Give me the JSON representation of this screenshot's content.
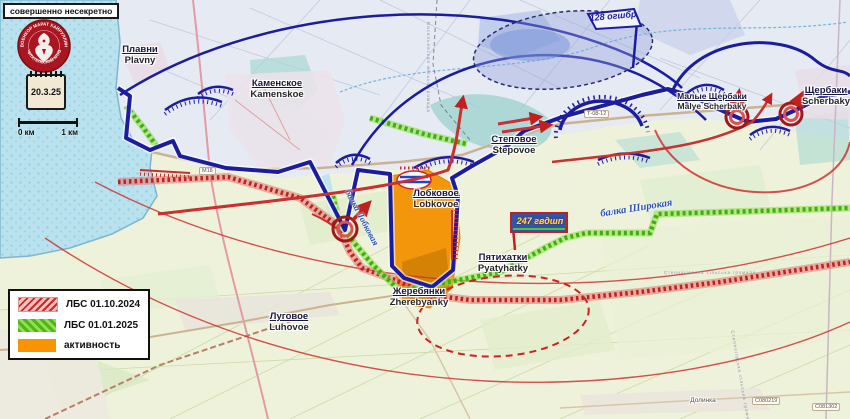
{
  "classification": "совершенно несекретно",
  "emblem": {
    "top": "ВОЕНКОР МАРАТ ХАЙРУЛЛИН",
    "bottom": "ЧИТАТЕЛЬСКИЙ КЛУБ"
  },
  "date_stamp": "20.3.25",
  "scale_bar": {
    "left": "0 км",
    "right": "1 км"
  },
  "legend": [
    {
      "label": "ЛБС  01.10.2024",
      "swatch": "red-hatch",
      "color": "#cf2626"
    },
    {
      "label": "ЛБС  01.01.2025",
      "swatch": "green-check",
      "color": "#4fb818"
    },
    {
      "label": "активность",
      "swatch": "orange-solid",
      "color": "#f79400"
    }
  ],
  "settlements": [
    {
      "ru": "Плавни",
      "en": "Plavny"
    },
    {
      "ru": "Каменское",
      "en": "Kamenskoe"
    },
    {
      "ru": "Степовое",
      "en": "Stepovoe"
    },
    {
      "ru": "Малые Щербаки",
      "en": "Malye Scherbaky"
    },
    {
      "ru": "Щербаки",
      "en": "Scherbaky"
    },
    {
      "ru": "Лобковое",
      "en": "Lobkovoe"
    },
    {
      "ru": "Пятихатки",
      "en": "Pyatyhatky"
    },
    {
      "ru": "Жеребянки",
      "en": "Zherebyanky"
    },
    {
      "ru": "Луговое",
      "en": "Luhovoe"
    },
    {
      "ru": "Долинка",
      "en": ""
    }
  ],
  "units": [
    {
      "label": "128 огшбр"
    },
    {
      "label": "247 гвдшп"
    }
  ],
  "terrain": [
    {
      "label": "балка  Широкая"
    },
    {
      "label": "балка Лобковая"
    }
  ],
  "road_labels": [
    {
      "label": "Т-08-12"
    },
    {
      "label": "М18"
    },
    {
      "label": "С080219"
    },
    {
      "label": "С081302"
    }
  ],
  "admin_labels": [
    {
      "label": "Васильевская міська громада"
    },
    {
      "label": "Степногірська сільська громада"
    }
  ],
  "colors": {
    "front_line": "#1c1c9e",
    "lbs_2024": "#c02020",
    "lbs_2025": "#3fae12",
    "activity": "#f49200",
    "water": "#b9e2ee"
  }
}
